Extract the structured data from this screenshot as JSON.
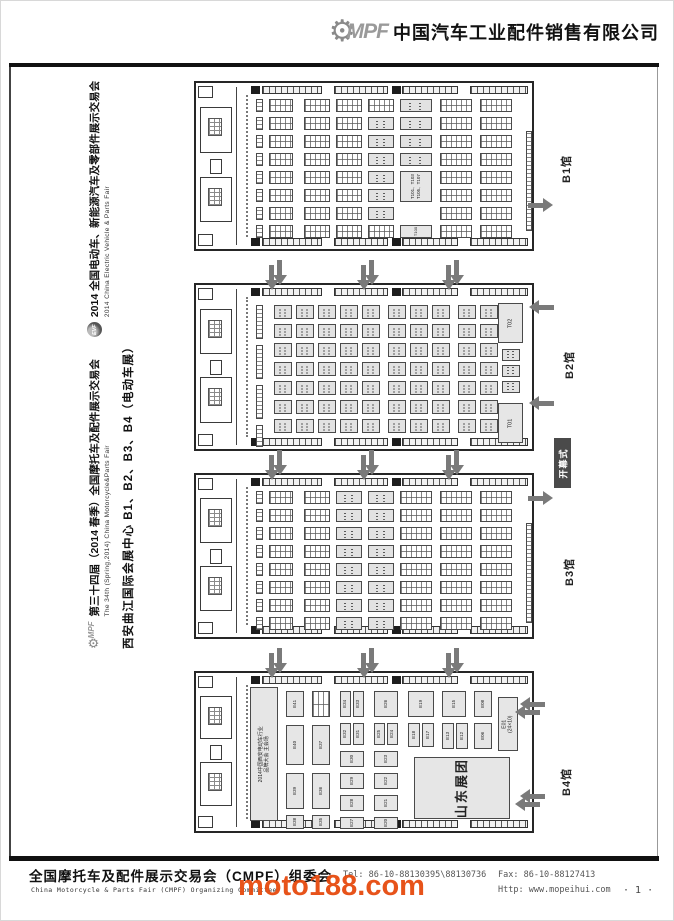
{
  "header": {
    "logo": "MPF",
    "company": "中国汽车工业配件销售有限公司"
  },
  "sidebar": {
    "fair1_logo": "MPF",
    "fair1_cn": "第三十四届（2014 春季）全国摩托车及配件展示交易会",
    "fair1_en": "The 34th (Spring,2014) China Motorcycle&Parts Fair",
    "fair2_logo": "EVF",
    "fair2_cn": "2014 全国电动车、新能源汽车及零部件展示交易会",
    "fair2_en": "2014 China Electric Vehicle & Parts Fair",
    "venue": "西安曲江国际会展中心 B1、B2、B3、B4（电动车展）"
  },
  "footer": {
    "org_cn": "全国摩托车及配件展示交易会（CMPF）组委会",
    "org_en": "China Motorcycle & Parts Fair (CMPF) Organizing Committee",
    "tel": "Tel: 86-10-88130395\\88130736",
    "fax": "Fax: 86-10-88127413",
    "http": "Http: www.mopeihui.com"
  },
  "page": {
    "watermark": "moto188.com",
    "page_number": "· 1 ·"
  },
  "halls": [
    {
      "id": "B1",
      "label": "B1馆",
      "top": 80,
      "height": 170,
      "type": "dense",
      "top_arrows": false,
      "side": {
        "label_x": 557,
        "label_y": 182,
        "arrows": [
          {
            "dir": "right",
            "x": 527,
            "y": 197,
            "double": false
          }
        ]
      },
      "big_block": {
        "lines": "T101、T103\nT105、T107"
      },
      "small_block": {
        "label": "T100"
      }
    },
    {
      "id": "B2",
      "label": "B2馆",
      "top": 282,
      "height": 168,
      "type": "medium",
      "top_arrows": true,
      "side": {
        "label_x": 560,
        "label_y": 378,
        "arrows": [
          {
            "dir": "left",
            "x": 527,
            "y": 299,
            "double": false
          },
          {
            "dir": "left",
            "x": 527,
            "y": 395,
            "double": false
          }
        ],
        "badge": {
          "text": "开幕式",
          "x": 553,
          "y": 437,
          "w": 17,
          "h": 50
        }
      },
      "featured": [
        {
          "label": "T02",
          "x": 302,
          "y": 18,
          "w": 25,
          "h": 40
        },
        {
          "label": "T01",
          "x": 302,
          "y": 118,
          "w": 25,
          "h": 40
        }
      ]
    },
    {
      "id": "B3",
      "label": "B3馆",
      "top": 472,
      "height": 166,
      "type": "dense",
      "top_arrows": true,
      "side": {
        "label_x": 560,
        "label_y": 585,
        "arrows": [
          {
            "dir": "right",
            "x": 527,
            "y": 490,
            "double": false
          }
        ]
      }
    },
    {
      "id": "B4",
      "label": "B4馆",
      "top": 670,
      "height": 162,
      "type": "large",
      "top_arrows": true,
      "side": {
        "label_x": 557,
        "label_y": 795,
        "arrows": [
          {
            "dir": "left",
            "x": 518,
            "y": 696,
            "double": true
          },
          {
            "dir": "left",
            "x": 518,
            "y": 788,
            "double": true
          }
        ]
      },
      "conference": {
        "label": "2014中国西安电动车行业\n品牌大会 主会场",
        "x": 54,
        "y": 14,
        "w": 28,
        "h": 134
      },
      "shandong": {
        "label": "山东展团",
        "x": 218,
        "y": 84,
        "w": 96,
        "h": 62
      },
      "e01": {
        "label": "E01\n(24×10)",
        "x": 302,
        "y": 24,
        "w": 20,
        "h": 54
      },
      "blocks": [
        {
          "x": 90,
          "y": 18,
          "w": 18,
          "h": 26,
          "label": "E41"
        },
        {
          "x": 90,
          "y": 52,
          "w": 18,
          "h": 40,
          "label": "E40"
        },
        {
          "x": 90,
          "y": 100,
          "w": 18,
          "h": 36,
          "label": "E39"
        },
        {
          "x": 90,
          "y": 142,
          "w": 18,
          "h": 14,
          "label": "E38"
        },
        {
          "x": 116,
          "y": 18,
          "w": 18,
          "h": 26,
          "label": "",
          "grid": true
        },
        {
          "x": 116,
          "y": 52,
          "w": 18,
          "h": 40,
          "label": "E37"
        },
        {
          "x": 116,
          "y": 100,
          "w": 18,
          "h": 36,
          "label": "E36"
        },
        {
          "x": 116,
          "y": 142,
          "w": 18,
          "h": 14,
          "label": "E35"
        },
        {
          "x": 144,
          "y": 18,
          "w": 11,
          "h": 26,
          "label": "E34"
        },
        {
          "x": 157,
          "y": 18,
          "w": 11,
          "h": 26,
          "label": "E33"
        },
        {
          "x": 144,
          "y": 50,
          "w": 11,
          "h": 22,
          "label": "E32"
        },
        {
          "x": 157,
          "y": 50,
          "w": 11,
          "h": 22,
          "label": "E31"
        },
        {
          "x": 144,
          "y": 78,
          "w": 24,
          "h": 16,
          "label": "E30"
        },
        {
          "x": 144,
          "y": 100,
          "w": 24,
          "h": 16,
          "label": "E29"
        },
        {
          "x": 144,
          "y": 122,
          "w": 24,
          "h": 16,
          "label": "E28"
        },
        {
          "x": 144,
          "y": 144,
          "w": 24,
          "h": 12,
          "label": "E27"
        },
        {
          "x": 178,
          "y": 18,
          "w": 24,
          "h": 26,
          "label": "E26"
        },
        {
          "x": 178,
          "y": 50,
          "w": 11,
          "h": 22,
          "label": "E25"
        },
        {
          "x": 191,
          "y": 50,
          "w": 11,
          "h": 22,
          "label": "E24"
        },
        {
          "x": 178,
          "y": 78,
          "w": 24,
          "h": 16,
          "label": "E23"
        },
        {
          "x": 178,
          "y": 100,
          "w": 24,
          "h": 16,
          "label": "E22"
        },
        {
          "x": 178,
          "y": 122,
          "w": 24,
          "h": 16,
          "label": "E21"
        },
        {
          "x": 178,
          "y": 144,
          "w": 24,
          "h": 12,
          "label": "E20"
        },
        {
          "x": 212,
          "y": 18,
          "w": 26,
          "h": 26,
          "label": "E19"
        },
        {
          "x": 212,
          "y": 50,
          "w": 12,
          "h": 24,
          "label": "E18"
        },
        {
          "x": 226,
          "y": 50,
          "w": 12,
          "h": 24,
          "label": "E17"
        },
        {
          "x": 246,
          "y": 18,
          "w": 24,
          "h": 26,
          "label": "E15"
        },
        {
          "x": 246,
          "y": 50,
          "w": 12,
          "h": 26,
          "label": "E13"
        },
        {
          "x": 260,
          "y": 50,
          "w": 12,
          "h": 26,
          "label": "E12"
        },
        {
          "x": 278,
          "y": 18,
          "w": 18,
          "h": 26,
          "label": "E08"
        },
        {
          "x": 278,
          "y": 50,
          "w": 18,
          "h": 26,
          "label": "E06"
        }
      ]
    }
  ]
}
